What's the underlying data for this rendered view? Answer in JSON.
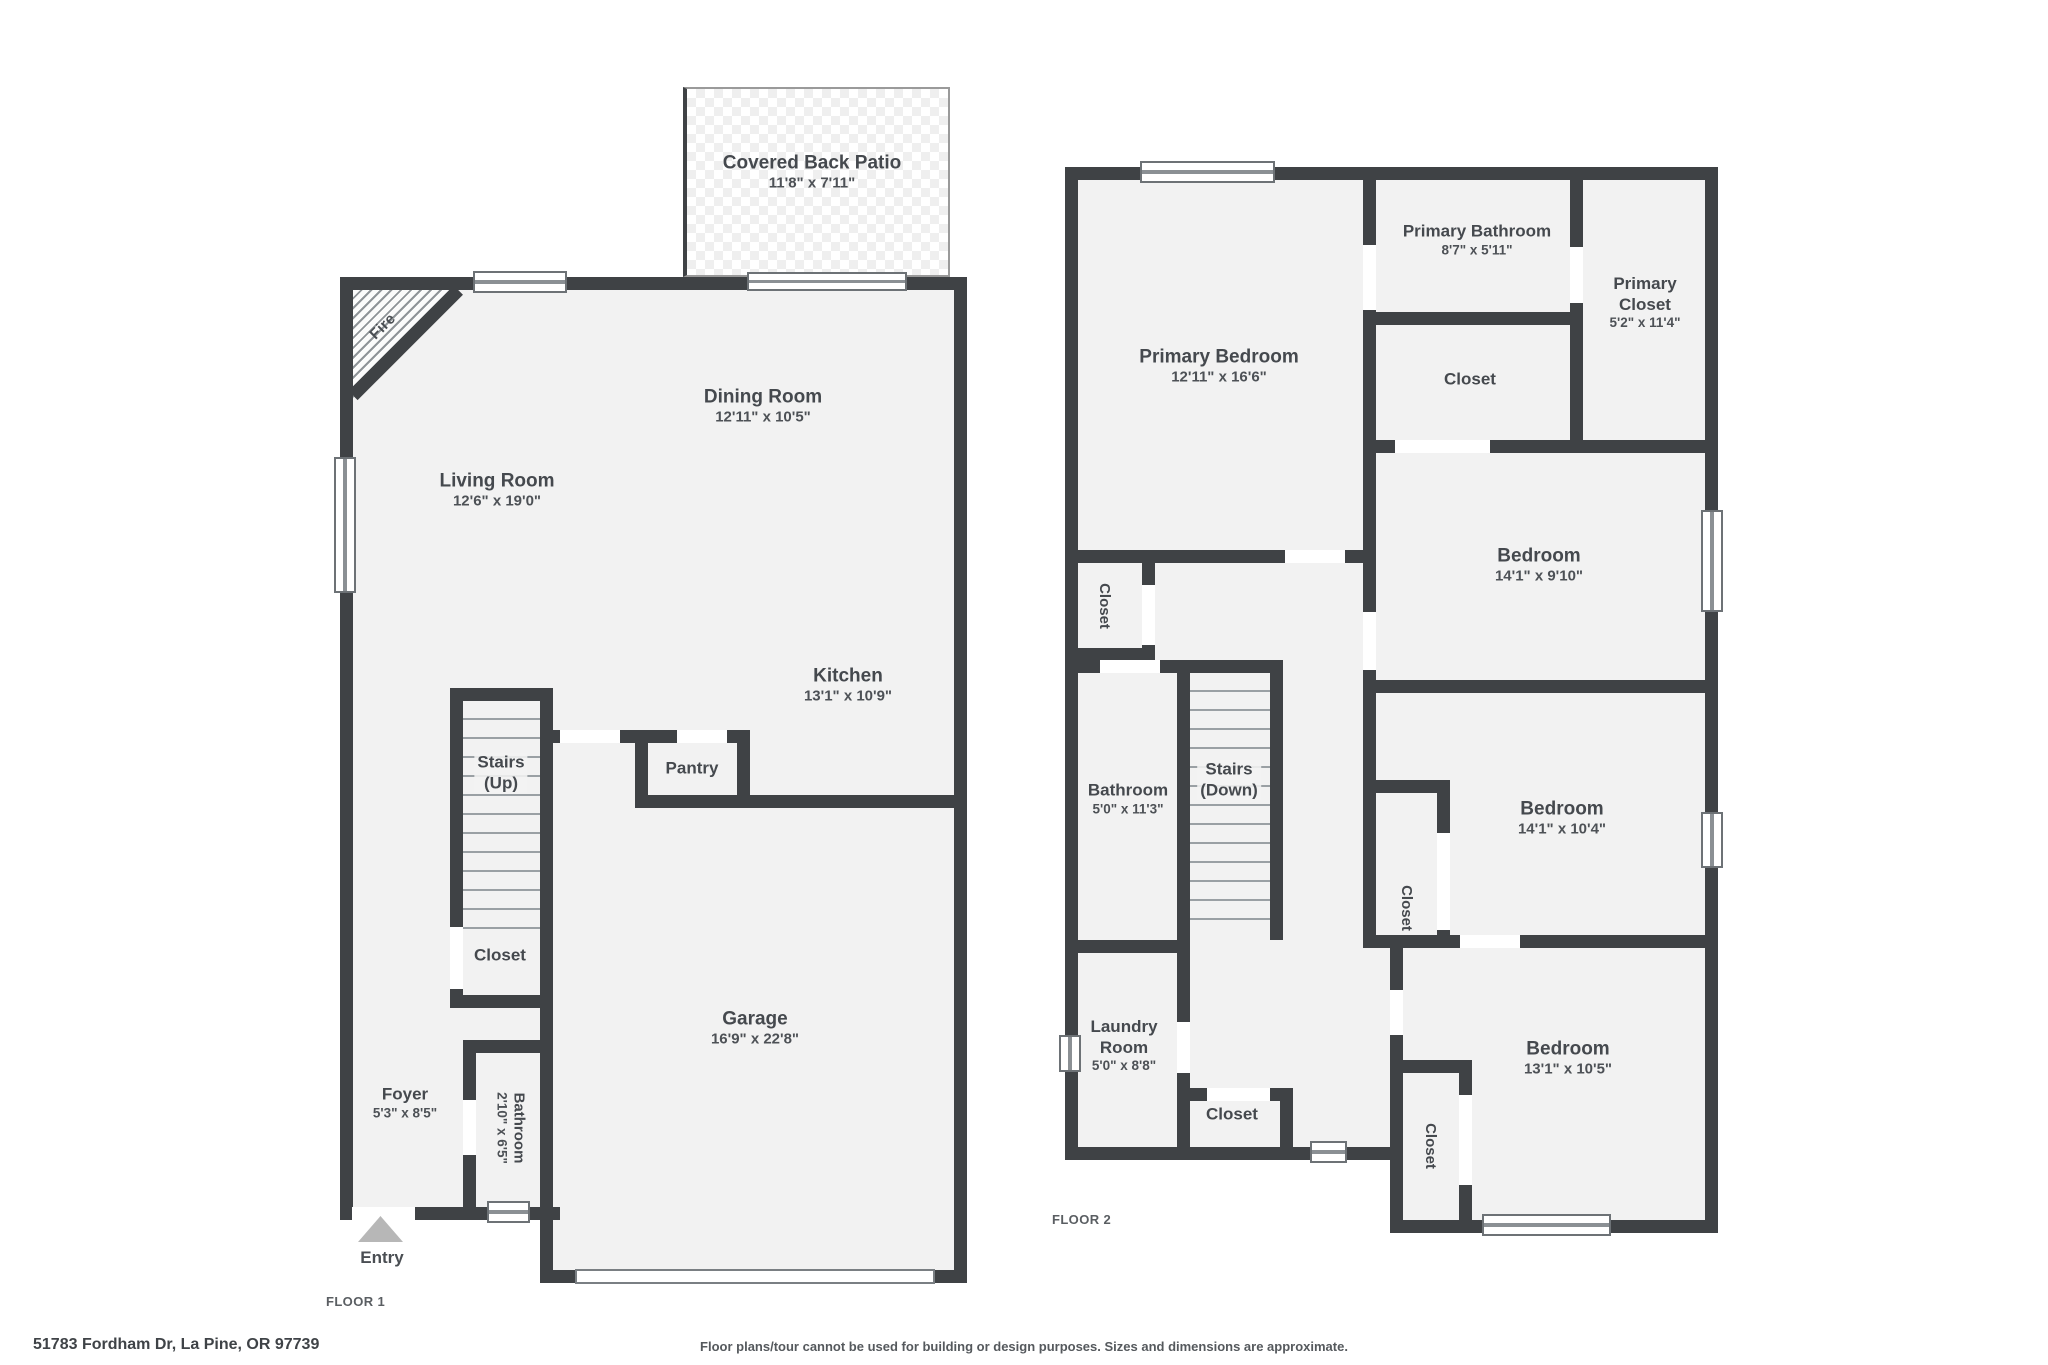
{
  "meta": {
    "address": "51783 Fordham Dr, La Pine, OR 97739",
    "disclaimer": "Floor plans/tour cannot be used for building or design purposes. Sizes and dimensions are approximate."
  },
  "floor1": {
    "tag": "FLOOR 1",
    "entry_label": "Entry",
    "fireplace_label": "Fire",
    "rooms": {
      "patio": [
        "Covered Back Patio",
        "11'8\" x 7'11\""
      ],
      "dining": [
        "Dining Room",
        "12'11\" x 10'5\""
      ],
      "living": [
        "Living Room",
        "12'6\" x 19'0\""
      ],
      "kitchen": [
        "Kitchen",
        "13'1\" x 10'9\""
      ],
      "stairs": [
        "Stairs",
        "(Up)"
      ],
      "pantry": [
        "Pantry"
      ],
      "closet": [
        "Closet"
      ],
      "foyer": [
        "Foyer",
        "5'3\" x 8'5\""
      ],
      "bathroom": [
        "Bathroom",
        "2'10\" x 6'5\""
      ],
      "garage": [
        "Garage",
        "16'9\" x 22'8\""
      ]
    }
  },
  "floor2": {
    "tag": "FLOOR 2",
    "rooms": {
      "primary_bedroom": [
        "Primary Bedroom",
        "12'11\" x 16'6\""
      ],
      "primary_bathroom": [
        "Primary Bathroom",
        "8'7\" x 5'11\""
      ],
      "primary_closet": [
        "Primary",
        "Closet",
        "5'2\" x 11'4\""
      ],
      "pb_closet": [
        "Closet"
      ],
      "bedroom1": [
        "Bedroom",
        "14'1\" x 9'10\""
      ],
      "hall_closet": [
        "Closet"
      ],
      "bathroom": [
        "Bathroom",
        "5'0\" x 11'3\""
      ],
      "stairs": [
        "Stairs",
        "(Down)"
      ],
      "b2_closet": [
        "Closet"
      ],
      "bedroom2": [
        "Bedroom",
        "14'1\" x 10'4\""
      ],
      "laundry": [
        "Laundry",
        "Room",
        "5'0\" x 8'8\""
      ],
      "us_closet": [
        "Closet"
      ],
      "b3_closet": [
        "Closet"
      ],
      "bedroom3": [
        "Bedroom",
        "13'1\" x 10'5\""
      ]
    }
  }
}
